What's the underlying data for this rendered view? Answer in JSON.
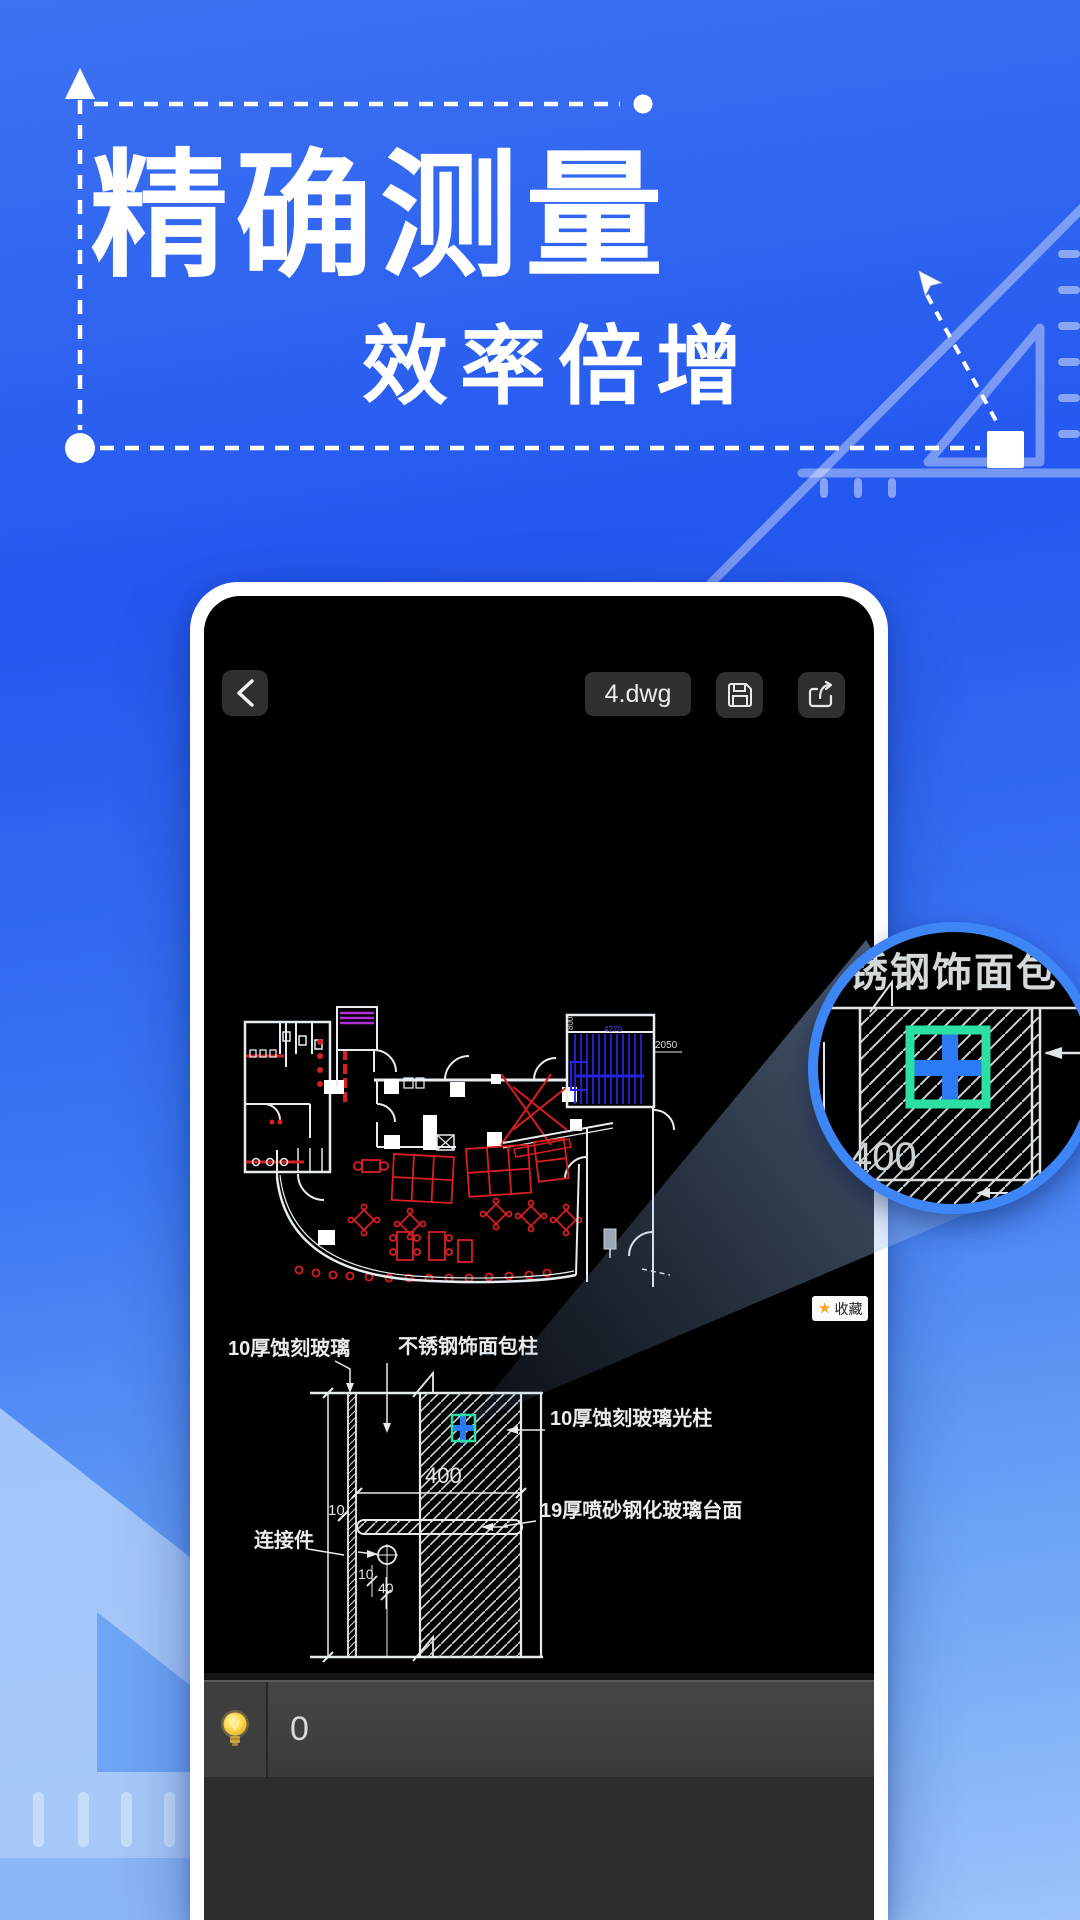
{
  "hero": {
    "title": "精确测量",
    "subtitle": "效率倍增"
  },
  "phone": {
    "header": {
      "file_chip": "4.dwg"
    },
    "floor_plan": {
      "dim_2050": "2050",
      "dim_4270": "4270",
      "dim_800": "800"
    },
    "favorite_badge": {
      "star": "★",
      "label": "收藏"
    },
    "detail": {
      "label_glass": "10厚蚀刻玻璃",
      "label_column_wrap": "不锈钢饰面包柱",
      "label_light_column": "10厚蚀刻玻璃光柱",
      "label_counter": "19厚喷砂钢化玻璃台面",
      "label_connector": "连接件",
      "dim_400": "400",
      "dim_10_glass": "10",
      "dim_10_conn": "10",
      "dim_40": "40"
    },
    "toolbar": {
      "value": "0"
    }
  },
  "magnifier": {
    "top_label": "不锈钢饰面包柱",
    "dim_400": "400"
  },
  "colors": {
    "accent_blue": "#2a7bf4",
    "ring_blue": "#3e86f5",
    "marker_teal": "#2ce0a2",
    "cad_red": "#d91f1f",
    "cad_blue": "#2424e0",
    "cad_purple": "#b02fd6",
    "star_orange": "#f5a623",
    "background_top": "#3d73f2",
    "background_bottom": "#9cc3fa"
  }
}
